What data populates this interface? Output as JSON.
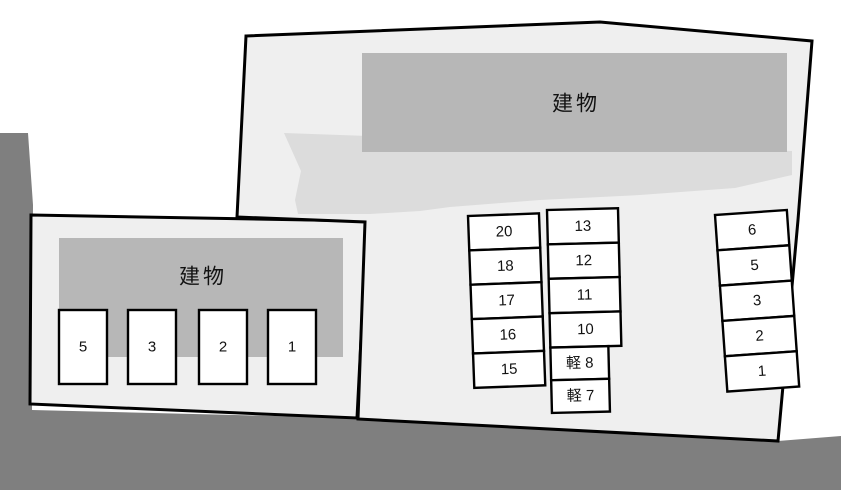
{
  "plan": {
    "colors": {
      "road": "#7f7f7f",
      "lot": "#efefef",
      "apron": "#dcdcdc",
      "building": "#b7b7b7",
      "stall": "#ffffff",
      "outline": "#000000"
    },
    "left_lot": {
      "building_label": "建物",
      "stalls": [
        "5",
        "3",
        "2",
        "1"
      ]
    },
    "right_lot": {
      "building_label": "建物",
      "column_a": [
        "20",
        "18",
        "17",
        "16",
        "15"
      ],
      "column_b": [
        "13",
        "12",
        "11",
        "10",
        "軽 8",
        "軽 7"
      ],
      "column_c": [
        "6",
        "5",
        "3",
        "2",
        "1"
      ]
    }
  }
}
